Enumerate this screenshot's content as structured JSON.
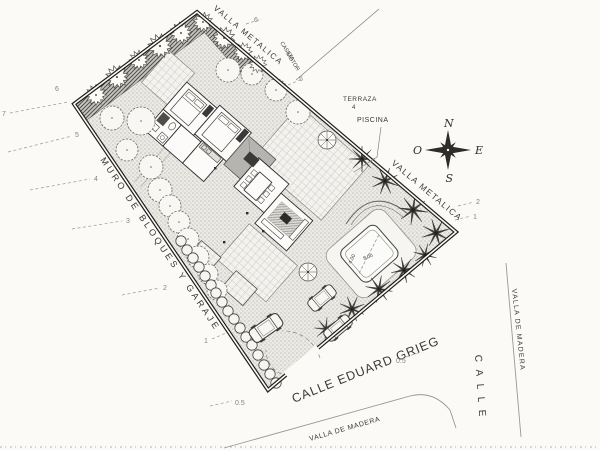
{
  "labels": {
    "fence_top": "VALLA METALICA",
    "fence_right": "VALLA METALICA",
    "wall_left": "MURO DE BLOQUES Y GARAJE",
    "street_bottom": "CALLE EDUARD GRIEG",
    "wood_fence_bottom": "VALLA DE MADERA",
    "wood_fence_right": "VALLA DE MADERA",
    "street_right": "CALLE",
    "caseta_line1": "CASETA",
    "caseta_line2": "MOTOR",
    "terrace": "TERRAZA",
    "terrace_level": "4",
    "pool": "PISCINA",
    "pool_width": "4.00",
    "pool_length": "8.00"
  },
  "compass": {
    "north": "N",
    "south": "S",
    "east": "E",
    "west": "O"
  },
  "contours": [
    {
      "v": "7"
    },
    {
      "v": "6"
    },
    {
      "v": "5"
    },
    {
      "v": "4"
    },
    {
      "v": "3"
    },
    {
      "v": "2"
    },
    {
      "v": "1"
    },
    {
      "v": "0.5"
    },
    {
      "v": "6"
    },
    {
      "v": "5"
    },
    {
      "v": "2"
    },
    {
      "v": "1"
    },
    {
      "v": "0.5"
    }
  ],
  "colors": {
    "paper": "#fbfaf7",
    "ink": "#2e2d2b",
    "light_ink": "#8a8882",
    "garden_band": "#c9c7c1",
    "porch_roof": "#b5b4b0"
  }
}
